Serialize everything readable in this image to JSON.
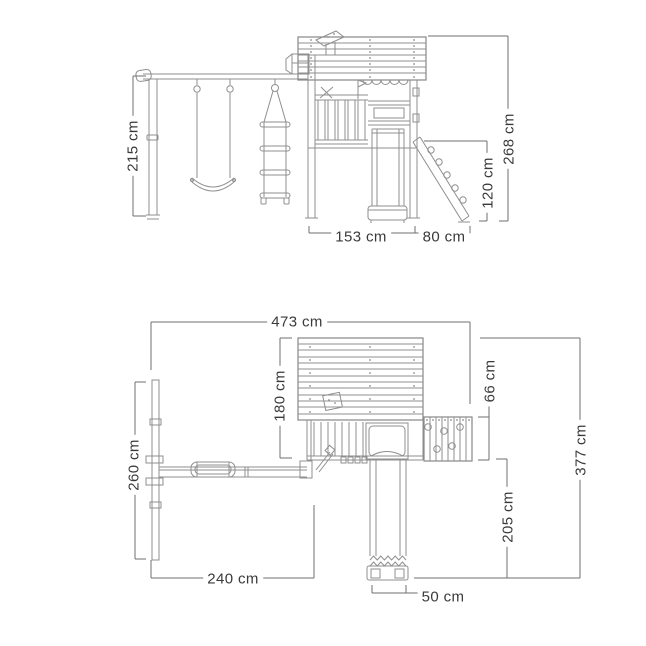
{
  "side_view": {
    "height_swing": "215 cm",
    "height_total": "268 cm",
    "height_ramp": "120 cm",
    "width_tower": "153 cm",
    "width_ramp": "80 cm"
  },
  "plan_view": {
    "width_total": "473 cm",
    "depth_tower": "180 cm",
    "depth_wall": "66 cm",
    "depth_total": "377 cm",
    "depth_swing": "260 cm",
    "width_swing": "240 cm",
    "length_slide": "205 cm",
    "width_slide": "50 cm"
  },
  "colors": {
    "structure_line": "#8f8f8f",
    "dimension_line": "#6f6f6f",
    "label_text": "#3a3a3a",
    "background": "#ffffff"
  }
}
